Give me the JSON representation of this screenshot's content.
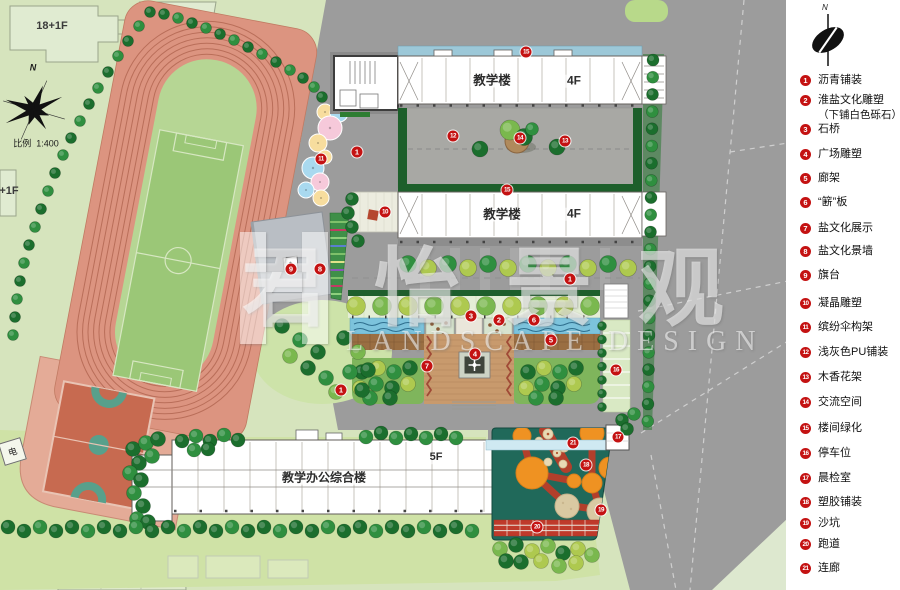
{
  "map": {
    "north_label": "N",
    "scale_label": "比例",
    "scale_value": "1:400",
    "context_building_label": "18+1F",
    "context_building_label_partial": "+1F",
    "utility_box_label": "电",
    "buildings": {
      "teaching_top": {
        "name": "教学楼",
        "floors": "4F"
      },
      "teaching_mid": {
        "name": "教学楼",
        "floors": "4F"
      },
      "office_complex": {
        "name": "教学办公综合楼",
        "floors": "5F"
      }
    },
    "markers": [
      {
        "n": "1",
        "x": 357,
        "y": 152
      },
      {
        "n": "1",
        "x": 570,
        "y": 279
      },
      {
        "n": "1",
        "x": 341,
        "y": 390
      },
      {
        "n": "2",
        "x": 499,
        "y": 320
      },
      {
        "n": "3",
        "x": 471,
        "y": 316
      },
      {
        "n": "4",
        "x": 475,
        "y": 354
      },
      {
        "n": "5",
        "x": 551,
        "y": 340
      },
      {
        "n": "6",
        "x": 534,
        "y": 320
      },
      {
        "n": "7",
        "x": 427,
        "y": 366
      },
      {
        "n": "8",
        "x": 320,
        "y": 269
      },
      {
        "n": "9",
        "x": 291,
        "y": 269
      },
      {
        "n": "10",
        "x": 385,
        "y": 212
      },
      {
        "n": "11",
        "x": 321,
        "y": 159
      },
      {
        "n": "12",
        "x": 453,
        "y": 136
      },
      {
        "n": "13",
        "x": 565,
        "y": 141
      },
      {
        "n": "14",
        "x": 520,
        "y": 138
      },
      {
        "n": "15",
        "x": 526,
        "y": 52
      },
      {
        "n": "15",
        "x": 507,
        "y": 190
      },
      {
        "n": "16",
        "x": 616,
        "y": 370
      },
      {
        "n": "17",
        "x": 618,
        "y": 437
      },
      {
        "n": "18",
        "x": 586,
        "y": 465
      },
      {
        "n": "19",
        "x": 601,
        "y": 510
      },
      {
        "n": "20",
        "x": 537,
        "y": 527
      },
      {
        "n": "21",
        "x": 573,
        "y": 443
      }
    ]
  },
  "watermark": {
    "cn": "君怡景观",
    "en": "LANDSCAPE DESIGN"
  },
  "legend": {
    "north_label": "N",
    "items": [
      {
        "num": "1",
        "label": "沥青铺装"
      },
      {
        "num": "2",
        "label": "淮盐文化雕塑",
        "label2": "（下铺白色砾石）"
      },
      {
        "num": "3",
        "label": "石桥"
      },
      {
        "num": "4",
        "label": "广场雕塑"
      },
      {
        "num": "5",
        "label": "廊架"
      },
      {
        "num": "6",
        "label": "“簖”板"
      },
      {
        "num": "7",
        "label": "盐文化展示"
      },
      {
        "num": "8",
        "label": "盐文化景墙"
      },
      {
        "num": "9",
        "label": "旗台"
      },
      {
        "num": "10",
        "label": "凝晶雕塑"
      },
      {
        "num": "11",
        "label": "缤纷伞构架"
      },
      {
        "num": "12",
        "label": "浅灰色PU铺装"
      },
      {
        "num": "13",
        "label": "木香花架"
      },
      {
        "num": "14",
        "label": "交流空间"
      },
      {
        "num": "15",
        "label": "楼间绿化"
      },
      {
        "num": "16",
        "label": "停车位"
      },
      {
        "num": "17",
        "label": "晨检室"
      },
      {
        "num": "18",
        "label": "塑胶铺装"
      },
      {
        "num": "19",
        "label": "沙坑"
      },
      {
        "num": "20",
        "label": "跑道"
      },
      {
        "num": "21",
        "label": "连廊"
      }
    ]
  },
  "colors": {
    "marker_red": "#c41212",
    "track_pink": "#dc9480",
    "water_blue": "#7cc3dc",
    "play_surface": "#20695a"
  }
}
